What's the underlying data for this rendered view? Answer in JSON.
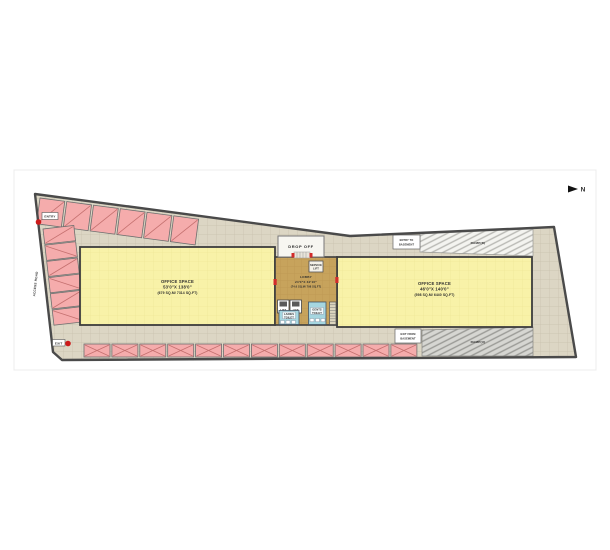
{
  "title": "Site / Floor Plan",
  "north": {
    "label": "N"
  },
  "site": {
    "entry_label": "ENTRY",
    "exit_label": "EXIT",
    "access_road_label": "ACCESS ROAD",
    "drop_off_label": "DROP OFF"
  },
  "basement": {
    "entry_line1": "ENTRY TO",
    "entry_line2": "BASEMENT",
    "exit_line1": "EXIT FROM",
    "exit_line2": "BASEMENT",
    "ramp_down_label": "RAMP(D)",
    "ramp_up_label": "RAMP(U)"
  },
  "rooms": {
    "office_left": {
      "name": "OFFICE SPACE",
      "dims": "53'0\"X 138'0\"",
      "area": "(679 SQ.M/ 7314 SQ.FT)"
    },
    "office_right": {
      "name": "OFFICE SPACE",
      "dims": "46'0\"X 140'0\"",
      "area": "(598 SQ.M/ 6440 SQ.FT)"
    },
    "lobby": {
      "name": "LOBBY",
      "dims": "24'0\"X 32'10\"",
      "area": "(74.6 SQ.M/ 798 SQ.FT)"
    },
    "ladies_toilet": {
      "line1": "LADIES",
      "line2": "TOILET"
    },
    "gents_toilet": {
      "line1": "GENTS",
      "line2": "TOILET"
    },
    "lift_left": {
      "name": "LIFT"
    },
    "lift_right": {
      "name": "LIFT"
    },
    "service_lift": {
      "line1": "SERVICE",
      "line2": "LIFT"
    }
  },
  "parking": {
    "top_row_count": 6,
    "left_col_count": 6,
    "bottom_row_count": 12,
    "stall_color": "#F5ACAC",
    "stall_line_color": "#C4706F"
  },
  "colors": {
    "paving": "#DCD6C4",
    "office": "#F8F2A8",
    "lobby": "#C7A35C",
    "toilet": "#A5D6E0",
    "ramp_light": "#F4F4F0",
    "ramp_dark": "#D6D6D2",
    "boundary": "#4A4A4A",
    "accent_red": "#CC1A1A"
  }
}
